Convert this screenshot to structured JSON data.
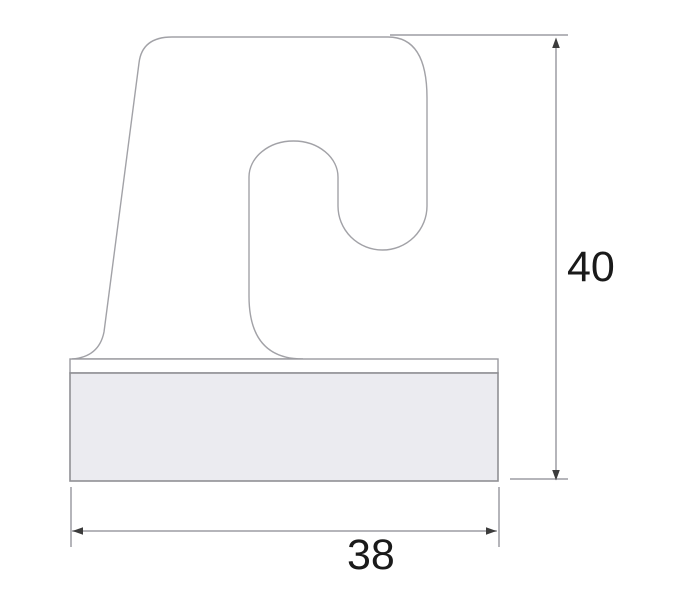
{
  "drawing": {
    "kind": "profile-cross-section-dimension-drawing",
    "background_color": "#ffffff",
    "outline_color": "#a2a2a7",
    "dimension_line_color": "#b5b5ba",
    "arrowhead_color": "#3c3c3c",
    "label_color": "#1a1a1a",
    "base_strip_fill": "#ffffff",
    "base_block_fill": "#ebebf0",
    "dimensions": {
      "height_label": "40",
      "width_label": "38"
    }
  }
}
